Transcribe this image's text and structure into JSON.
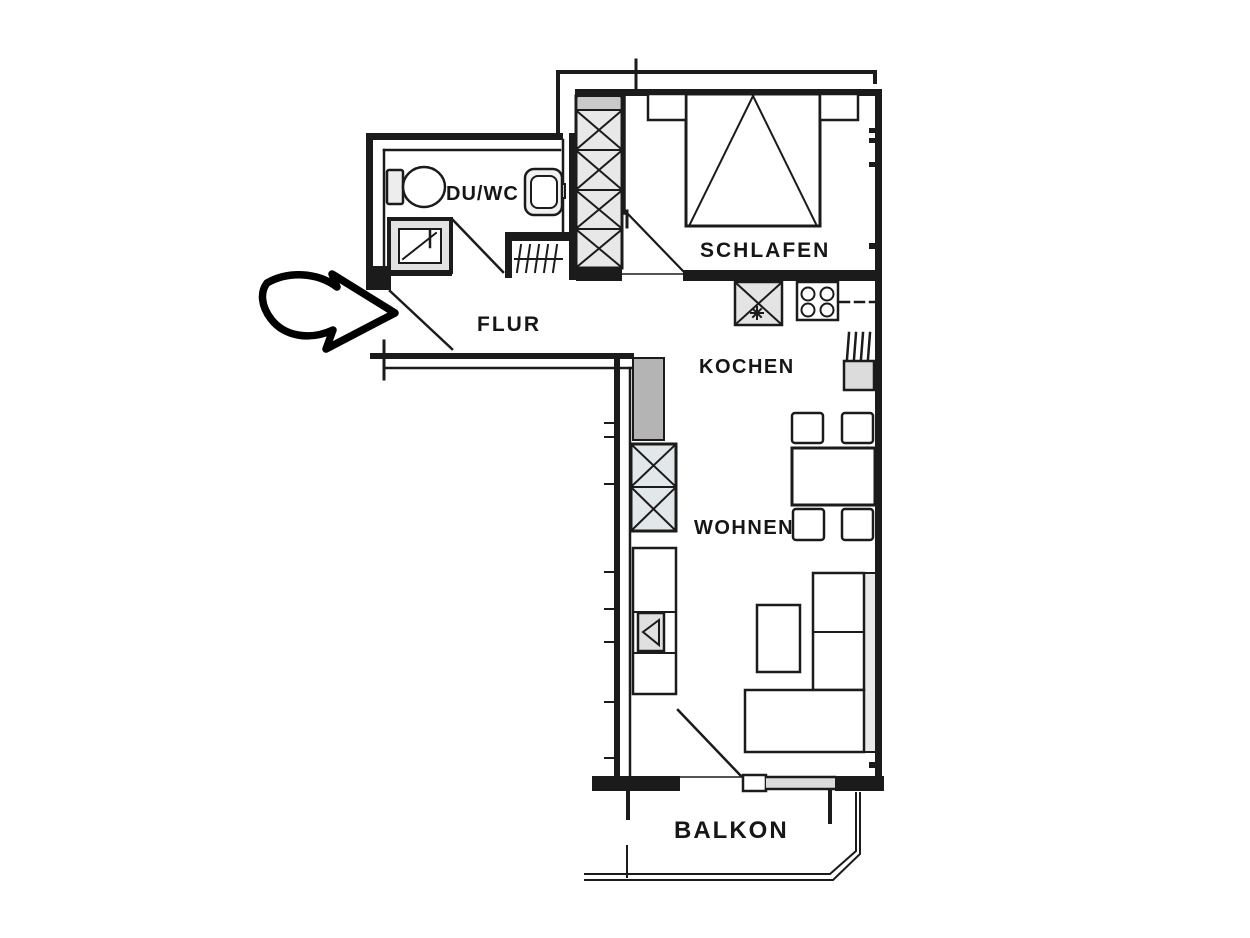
{
  "colors": {
    "line": "#1b1b1b",
    "light_fill": "#e7e7e7",
    "mid_gray": "#b4b4b4",
    "window_fill": "#dcdcdc",
    "background": "#ffffff"
  },
  "rooms": {
    "du_wc": {
      "label": "DU/WC"
    },
    "schlafen": {
      "label": "SCHLAFEN"
    },
    "flur": {
      "label": "FLUR"
    },
    "kochen": {
      "label": "KOCHEN"
    },
    "wohnen": {
      "label": "WOHNEN"
    },
    "balkon": {
      "label": "BALKON"
    }
  },
  "symbols": [
    "entrance-arrow-icon",
    "entrance-door",
    "toilet-icon",
    "washbasin-icon",
    "shower-icon",
    "radiator-icon",
    "wardrobe-icon",
    "bed-icon",
    "nightstand-icon",
    "bedroom-door",
    "kitchen-sink-icon",
    "stove-icon",
    "kitchen-appliance-icon",
    "counter-dashed-line",
    "duct-block",
    "living-wardrobe-icon",
    "tv-cabinet-icon",
    "coffee-table-icon",
    "dining-table-icon",
    "chair-icon",
    "corner-sofa-icon",
    "balcony-door",
    "balcony-window",
    "balcony-railing"
  ]
}
